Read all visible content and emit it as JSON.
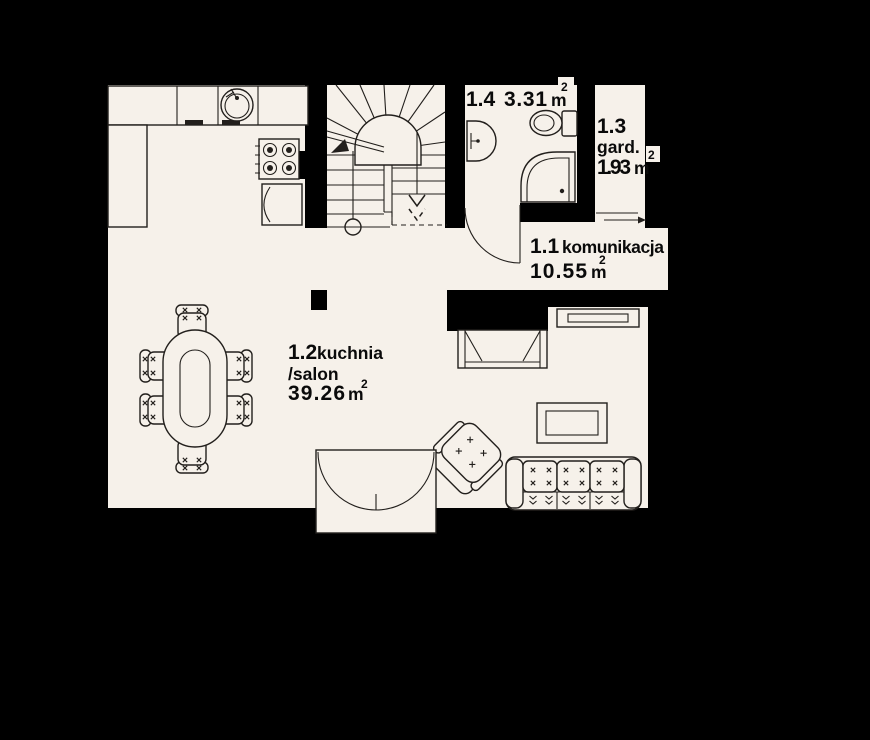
{
  "colors": {
    "background": "#000000",
    "floor": "#f6f1ea",
    "line": "#221f1c",
    "text": "#0a0a0a"
  },
  "plan": {
    "type": "floor-plan",
    "rooms": [
      {
        "number": "1.1",
        "name": "komunikacja",
        "area": "10.55",
        "unit": "m",
        "sup": "2"
      },
      {
        "number": "1.2",
        "name": "kuchnia",
        "name2": "/salon",
        "area": "39.26",
        "unit": "m",
        "sup": "2"
      },
      {
        "number": "1.3",
        "name": "gard.",
        "area": "1.93",
        "unit": "m",
        "sup": "2"
      },
      {
        "number": "1.4",
        "name": "",
        "area": "3.31",
        "unit": "m",
        "sup": "2"
      }
    ],
    "furniture_icons": [
      "kitchen-counter",
      "kitchen-sink",
      "cooktop",
      "fridge",
      "winder-staircase",
      "washbasin",
      "toilet",
      "shower",
      "bathroom-door",
      "sliding-door",
      "terrace-double-door",
      "dining-table",
      "dining-chair",
      "sofa",
      "armchair",
      "coffee-table",
      "sideboard",
      "fireplace",
      "column"
    ]
  }
}
